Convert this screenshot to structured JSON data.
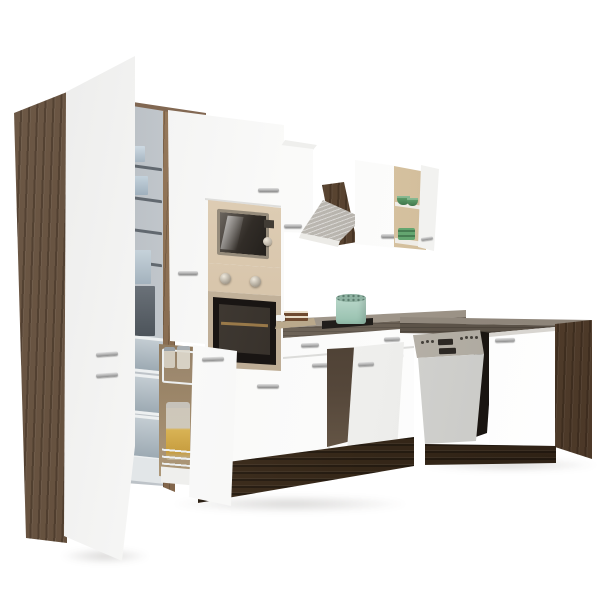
{
  "scene": {
    "description": "L-shaped kitchen set product photo: white fronts, dark yorki-oak carcass, built-in appliances, white background",
    "objects": {
      "fridge_cabinet": "tall fridge-freezer cabinet with open white door",
      "fridge_interior": "fridge interior with wire shelves and storage boxes",
      "freezer_drawers": "three grey freezer drawers",
      "pantry_pullout": "pull-out larder with wire baskets and glass jars",
      "oven_column": "tall housing with built-in microwave and oven",
      "microwave": "built-in microwave, champagne steel frame",
      "oven": "built-in oven, black glass door, two knobs",
      "extractor_hood": "stainless chimney hood on oak panel",
      "wall_cabinet_left": "white wall cabinet",
      "wall_cabinet_mid": "white wall cabinet",
      "wall_shelf_open": "open wall cabinet with green bowls",
      "hob": "black glass hob",
      "pot": "mint green pot on hob",
      "cutting_board": "board with layered cake",
      "sink_cabinet": "base cabinet with open door",
      "dishwasher": "semi-integrated dishwasher with steel control panel",
      "base_cabinet_right": "white base cabinet",
      "end_panel": "dark oak end panel",
      "countertop": "grey-brown worktop",
      "plinth": "dark oak plinth"
    },
    "counts": {
      "freezer_drawers": 3,
      "pantry_jars": 3,
      "green_bowl_shelves": 2,
      "oven_knobs": 2
    },
    "palette": {
      "background": "#ffffff",
      "front_white": "#f9f9f8",
      "oak_dark": "#5e4c3d",
      "oak_plinth": "#3a2d24",
      "worktop": "#6e655a",
      "steel_champagne": "#cdbaa0",
      "steel_silver": "#b5b1aa",
      "oven_glass": "#1b1713",
      "pot_mint": "#a8cdbf",
      "bowl_green": "#4e8f5c",
      "fridge_interior_grey": "#c9cfd4",
      "handle_silver": "#b8b8b8"
    }
  }
}
